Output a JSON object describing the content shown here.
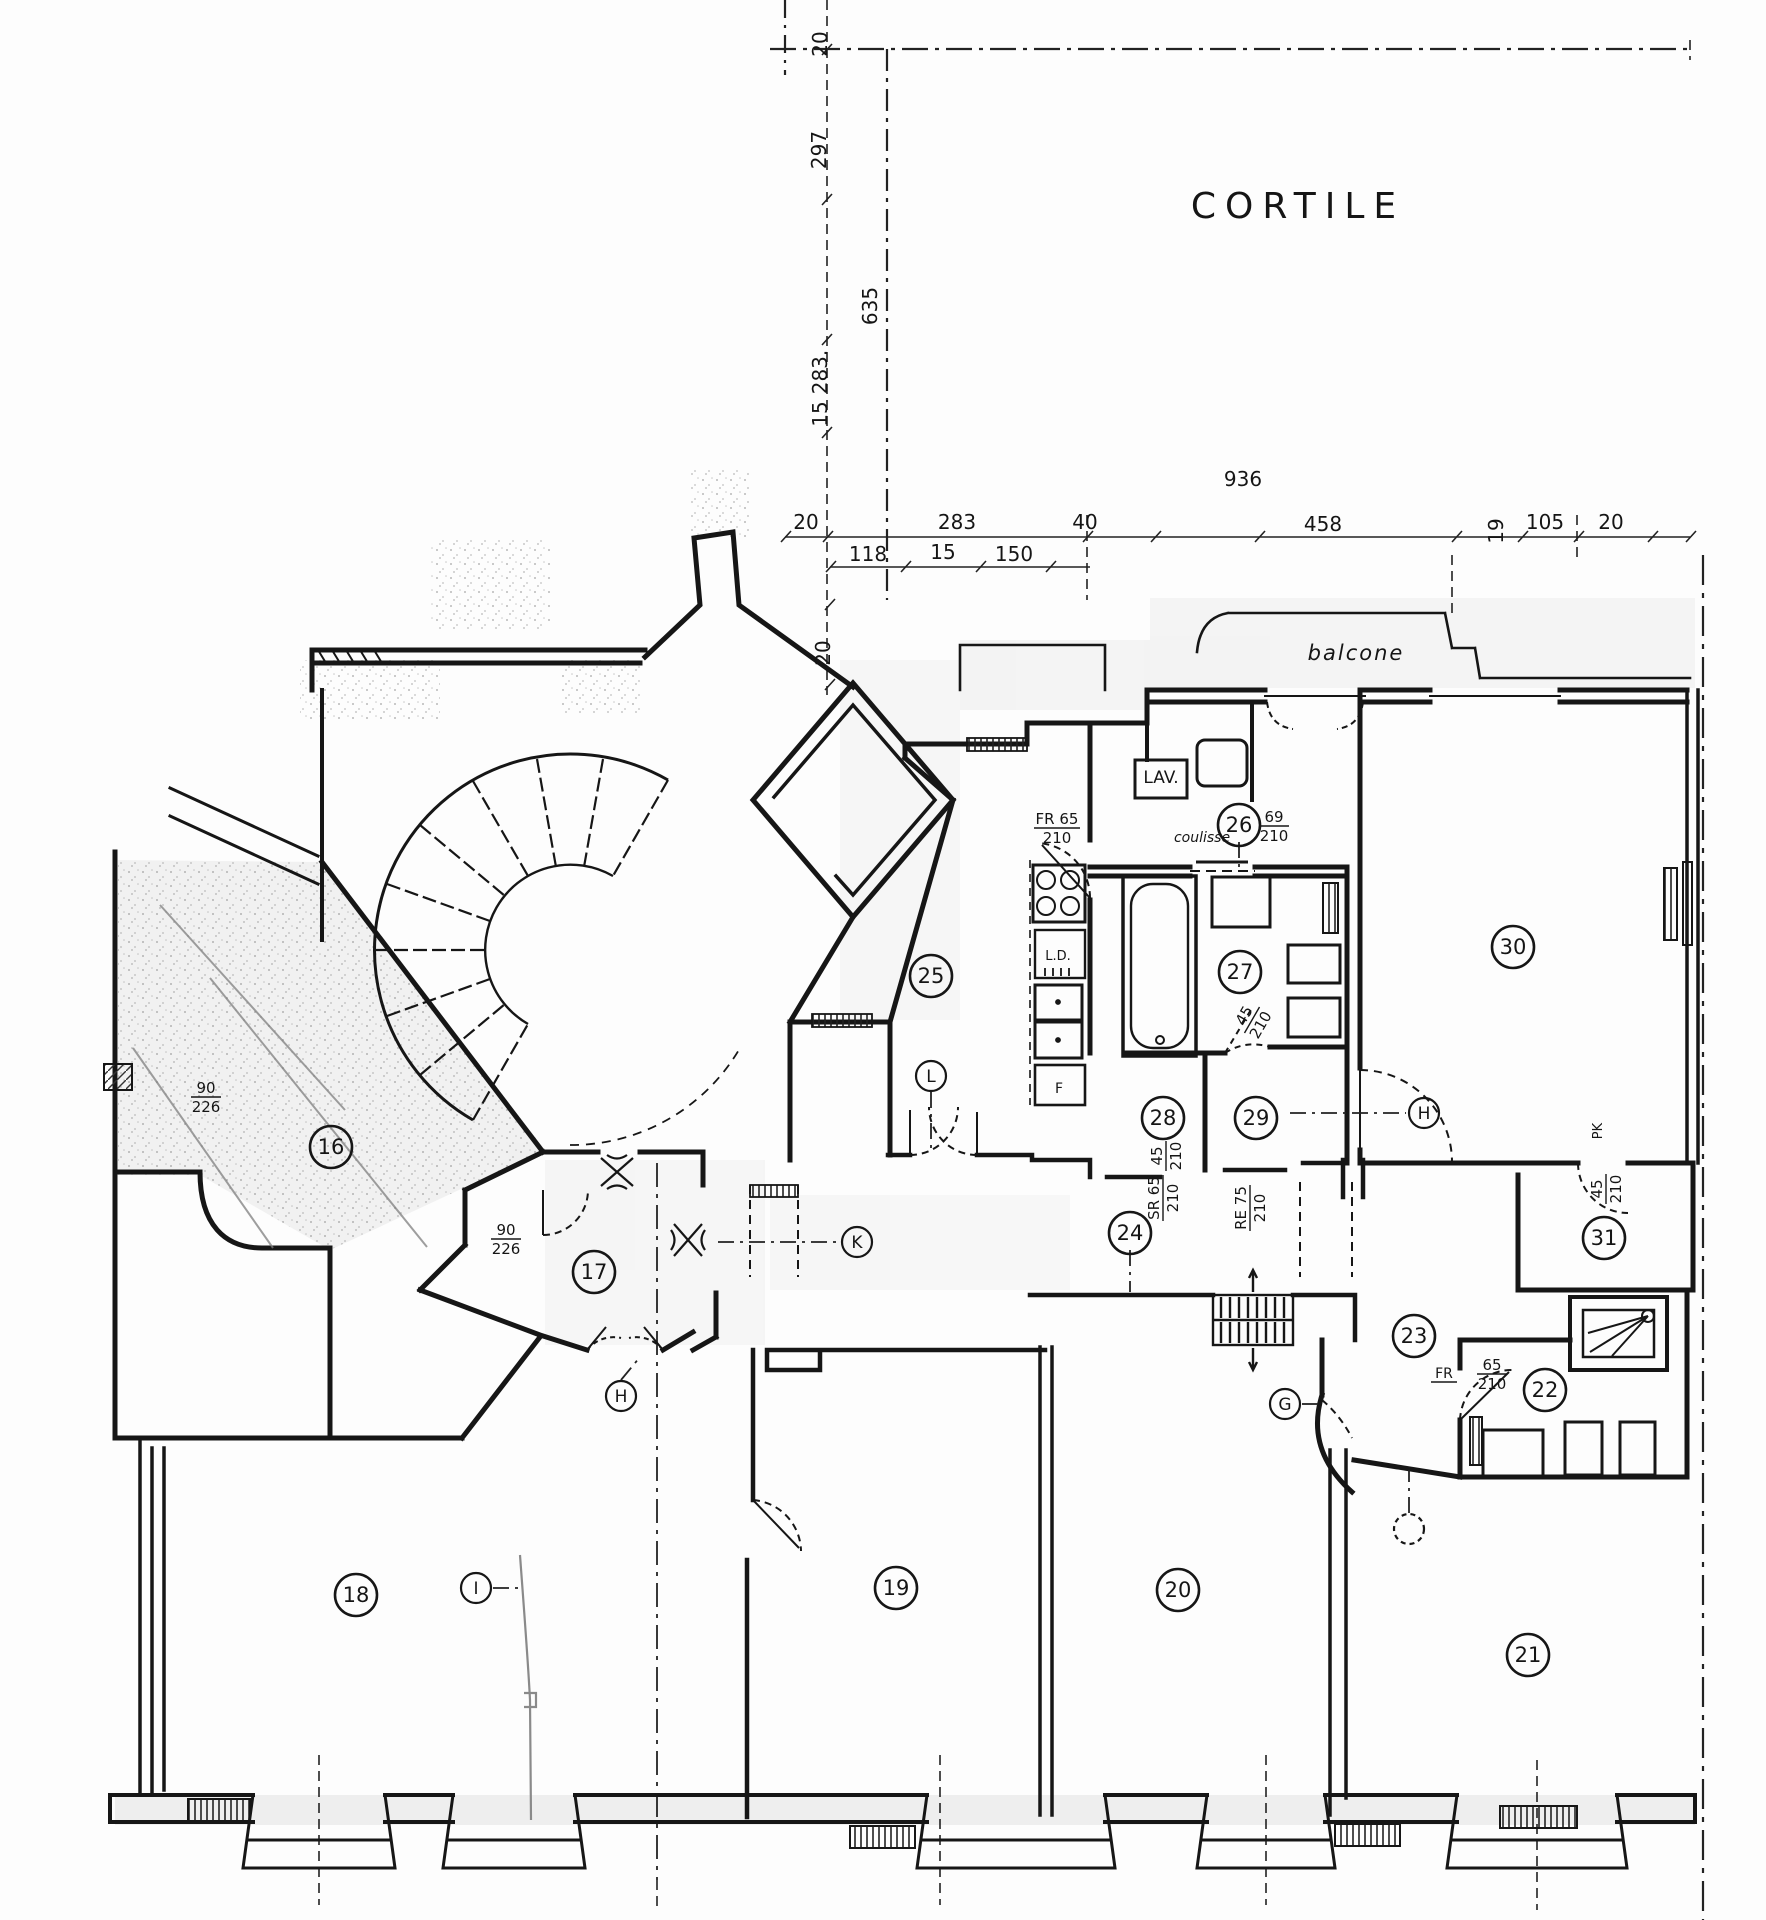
{
  "document": {
    "kind": "scanned apartment floor plan",
    "ink_color": "#161616",
    "paper_color": "#fdfdfd",
    "area_labels": [
      {
        "id": "cortile",
        "text": "CORTILE",
        "x": 1298,
        "y": 218,
        "size": 36,
        "spacing": 9
      },
      {
        "id": "balcone",
        "text": "balcone",
        "x": 1356,
        "y": 660,
        "size": 21,
        "spacing": 2
      }
    ],
    "room_numbers": [
      {
        "n": "16",
        "x": 331,
        "y": 1147
      },
      {
        "n": "17",
        "x": 594,
        "y": 1272
      },
      {
        "n": "18",
        "x": 356,
        "y": 1595
      },
      {
        "n": "19",
        "x": 896,
        "y": 1588
      },
      {
        "n": "20",
        "x": 1178,
        "y": 1590
      },
      {
        "n": "21",
        "x": 1528,
        "y": 1655
      },
      {
        "n": "22",
        "x": 1545,
        "y": 1390
      },
      {
        "n": "23",
        "x": 1414,
        "y": 1336
      },
      {
        "n": "24",
        "x": 1130,
        "y": 1233
      },
      {
        "n": "25",
        "x": 931,
        "y": 976
      },
      {
        "n": "26",
        "x": 1239,
        "y": 825
      },
      {
        "n": "27",
        "x": 1240,
        "y": 972
      },
      {
        "n": "28",
        "x": 1163,
        "y": 1118
      },
      {
        "n": "29",
        "x": 1256,
        "y": 1118
      },
      {
        "n": "30",
        "x": 1513,
        "y": 947
      },
      {
        "n": "31",
        "x": 1604,
        "y": 1238
      }
    ],
    "door_letters": [
      {
        "n": "L",
        "x": 931,
        "y": 1076
      },
      {
        "n": "K",
        "x": 857,
        "y": 1242
      },
      {
        "n": "H",
        "x": 621,
        "y": 1396
      },
      {
        "n": "H",
        "x": 1424,
        "y": 1113
      },
      {
        "n": "I",
        "x": 476,
        "y": 1588
      },
      {
        "n": "G",
        "x": 1285,
        "y": 1404
      },
      {
        "n": "",
        "x": 1409,
        "y": 1529,
        "dashed": true
      }
    ],
    "fixture_labels": [
      {
        "text": "LAV.",
        "x": 1161,
        "y": 783,
        "size": 17,
        "rot": 0
      },
      {
        "text": "coulisse",
        "x": 1202,
        "y": 842,
        "size": 14,
        "rot": 0,
        "script": true
      },
      {
        "text": "L.D.",
        "x": 1058,
        "y": 960,
        "size": 13,
        "rot": 0
      },
      {
        "text": "F",
        "x": 1059,
        "y": 1093,
        "size": 14,
        "rot": 0
      },
      {
        "text": "PK",
        "x": 1602,
        "y": 1131,
        "size": 13,
        "rot": -90
      },
      {
        "text": "FR",
        "x": 1444,
        "y": 1378,
        "size": 14,
        "rot": 0,
        "underline": true
      }
    ],
    "door_size_labels": [
      {
        "top": "FR 65",
        "bottom": "210",
        "x": 1057,
        "y": 828,
        "rot": 0
      },
      {
        "top": "69",
        "bottom": "210",
        "x": 1274,
        "y": 826,
        "rot": 0
      },
      {
        "top": "45",
        "bottom": "210",
        "x": 1252,
        "y": 1020,
        "rot": -60
      },
      {
        "top": "45",
        "bottom": "210",
        "x": 1166,
        "y": 1156,
        "rot": -90
      },
      {
        "top": "SR 65",
        "bottom": "210",
        "x": 1163,
        "y": 1198,
        "rot": -90
      },
      {
        "top": "RE 75",
        "bottom": "210",
        "x": 1250,
        "y": 1208,
        "rot": -90
      },
      {
        "top": "45",
        "bottom": "210",
        "x": 1606,
        "y": 1189,
        "rot": -90
      },
      {
        "top": "65",
        "bottom": "210",
        "x": 1492,
        "y": 1374,
        "rot": 0
      },
      {
        "top": "90",
        "bottom": "226",
        "x": 206,
        "y": 1097,
        "rot": 0
      },
      {
        "top": "90",
        "bottom": "226",
        "x": 506,
        "y": 1239,
        "rot": 0
      }
    ],
    "dimensions_horizontal": [
      {
        "text": "936",
        "x": 1243,
        "y": 486
      },
      {
        "text": "20",
        "x": 806,
        "y": 529
      },
      {
        "text": "283",
        "x": 957,
        "y": 529
      },
      {
        "text": "40",
        "x": 1085,
        "y": 529
      },
      {
        "text": "458",
        "x": 1323,
        "y": 531
      },
      {
        "text": "105",
        "x": 1545,
        "y": 529
      },
      {
        "text": "20",
        "x": 1611,
        "y": 529
      },
      {
        "text": "118",
        "x": 868,
        "y": 561
      },
      {
        "text": "15",
        "x": 943,
        "y": 559
      },
      {
        "text": "150",
        "x": 1014,
        "y": 561
      }
    ],
    "dimensions_vertical": [
      {
        "text": "20",
        "x": 827,
        "y": 44
      },
      {
        "text": "297",
        "x": 826,
        "y": 150
      },
      {
        "text": "635",
        "x": 877,
        "y": 306
      },
      {
        "text": "283.",
        "x": 827,
        "y": 372
      },
      {
        "text": "15",
        "x": 827,
        "y": 414
      },
      {
        "text": "20",
        "x": 830,
        "y": 653
      },
      {
        "text": "19",
        "x": 1503,
        "y": 531
      }
    ]
  }
}
